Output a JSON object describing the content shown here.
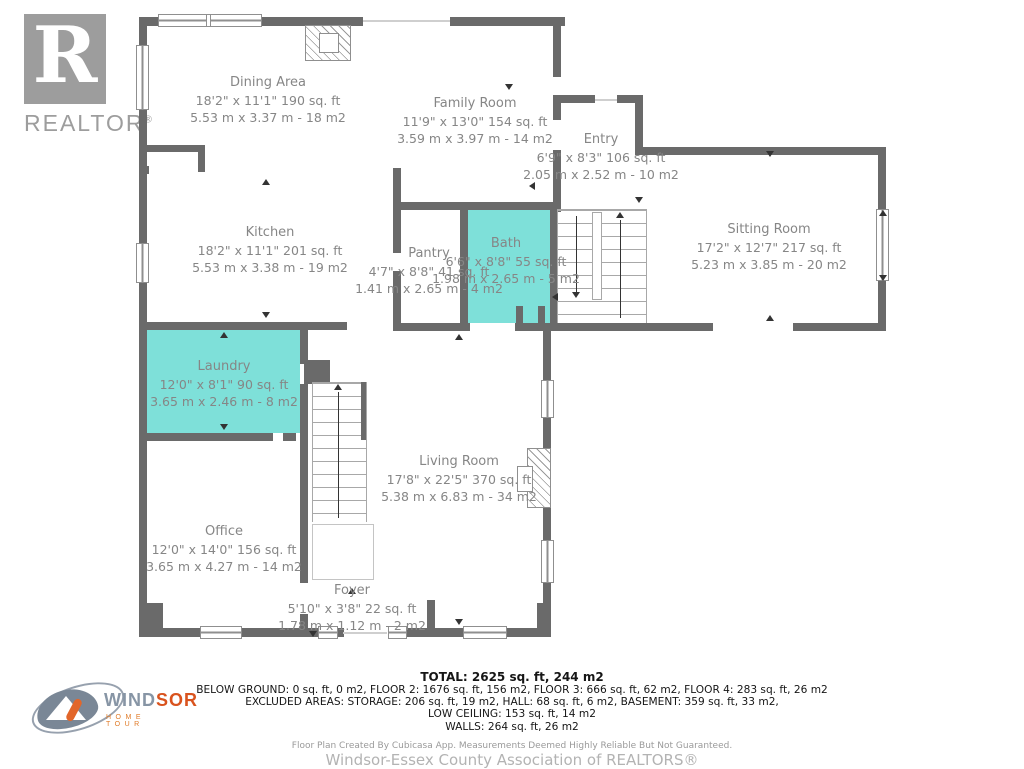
{
  "branding": {
    "realtor_r": "R",
    "realtor_word": "REALTOR",
    "registered": "®",
    "windsor_wind": "WIND",
    "windsor_sor": "SOR",
    "windsor_hometour": "HOME TOUR"
  },
  "rooms": [
    {
      "name": "Dining Area",
      "imperial": "18'2\" x 11'1\" 190 sq. ft",
      "metric": "5.53 m x 3.37 m - 18 m2"
    },
    {
      "name": "Family Room",
      "imperial": "11'9\" x 13'0\" 154 sq. ft",
      "metric": "3.59 m x 3.97 m - 14 m2"
    },
    {
      "name": "Entry",
      "imperial": "6'9\" x 8'3\" 106 sq. ft",
      "metric": "2.05 m x 2.52 m - 10 m2"
    },
    {
      "name": "Kitchen",
      "imperial": "18'2\" x 11'1\" 201 sq. ft",
      "metric": "5.53 m x 3.38 m - 19 m2"
    },
    {
      "name": "Pantry",
      "imperial": "4'7\" x 8'8\" 41 sq. ft",
      "metric": "1.41 m x 2.65 m - 4 m2"
    },
    {
      "name": "Bath",
      "imperial": "6'6\" x 8'8\" 55 sq. ft",
      "metric": "1.98 m x 2.65 m - 5 m2"
    },
    {
      "name": "Sitting Room",
      "imperial": "17'2\" x 12'7\" 217 sq. ft",
      "metric": "5.23 m x 3.85 m - 20 m2"
    },
    {
      "name": "Laundry",
      "imperial": "12'0\" x 8'1\" 90 sq. ft",
      "metric": "3.65 m x 2.46 m - 8 m2"
    },
    {
      "name": "Living Room",
      "imperial": "17'8\" x 22'5\" 370 sq. ft",
      "metric": "5.38 m x 6.83 m - 34 m2"
    },
    {
      "name": "Office",
      "imperial": "12'0\" x 14'0\" 156 sq. ft",
      "metric": "3.65 m x 4.27 m - 14 m2"
    },
    {
      "name": "Foyer",
      "imperial": "5'10\" x 3'8\" 22 sq. ft",
      "metric": "1.78 m x 1.12 m - 2 m2"
    }
  ],
  "summary": {
    "total": "TOTAL: 2625 sq. ft, 244 m2",
    "line2": "BELOW GROUND: 0 sq. ft, 0 m2, FLOOR 2: 1676 sq. ft, 156 m2, FLOOR 3: 666 sq. ft, 62 m2, FLOOR 4: 283 sq. ft, 26 m2",
    "line3": "EXCLUDED AREAS: STORAGE: 206 sq. ft, 19 m2, HALL: 68 sq. ft, 6 m2, BASEMENT: 359 sq. ft, 33 m2,",
    "line4": "LOW CEILING: 153 sq. ft, 14 m2",
    "line5": "WALLS: 264 sq. ft, 26 m2"
  },
  "footer": {
    "disclaimer": "Floor Plan Created By Cubicasa App. Measurements Deemed Highly Reliable But Not Guaranteed.",
    "association": "Windsor-Essex County Association of REALTORS®"
  },
  "colors": {
    "wall": "#6a6a6a",
    "highlight_room": "#7ee0d9",
    "label_text": "#868686"
  }
}
